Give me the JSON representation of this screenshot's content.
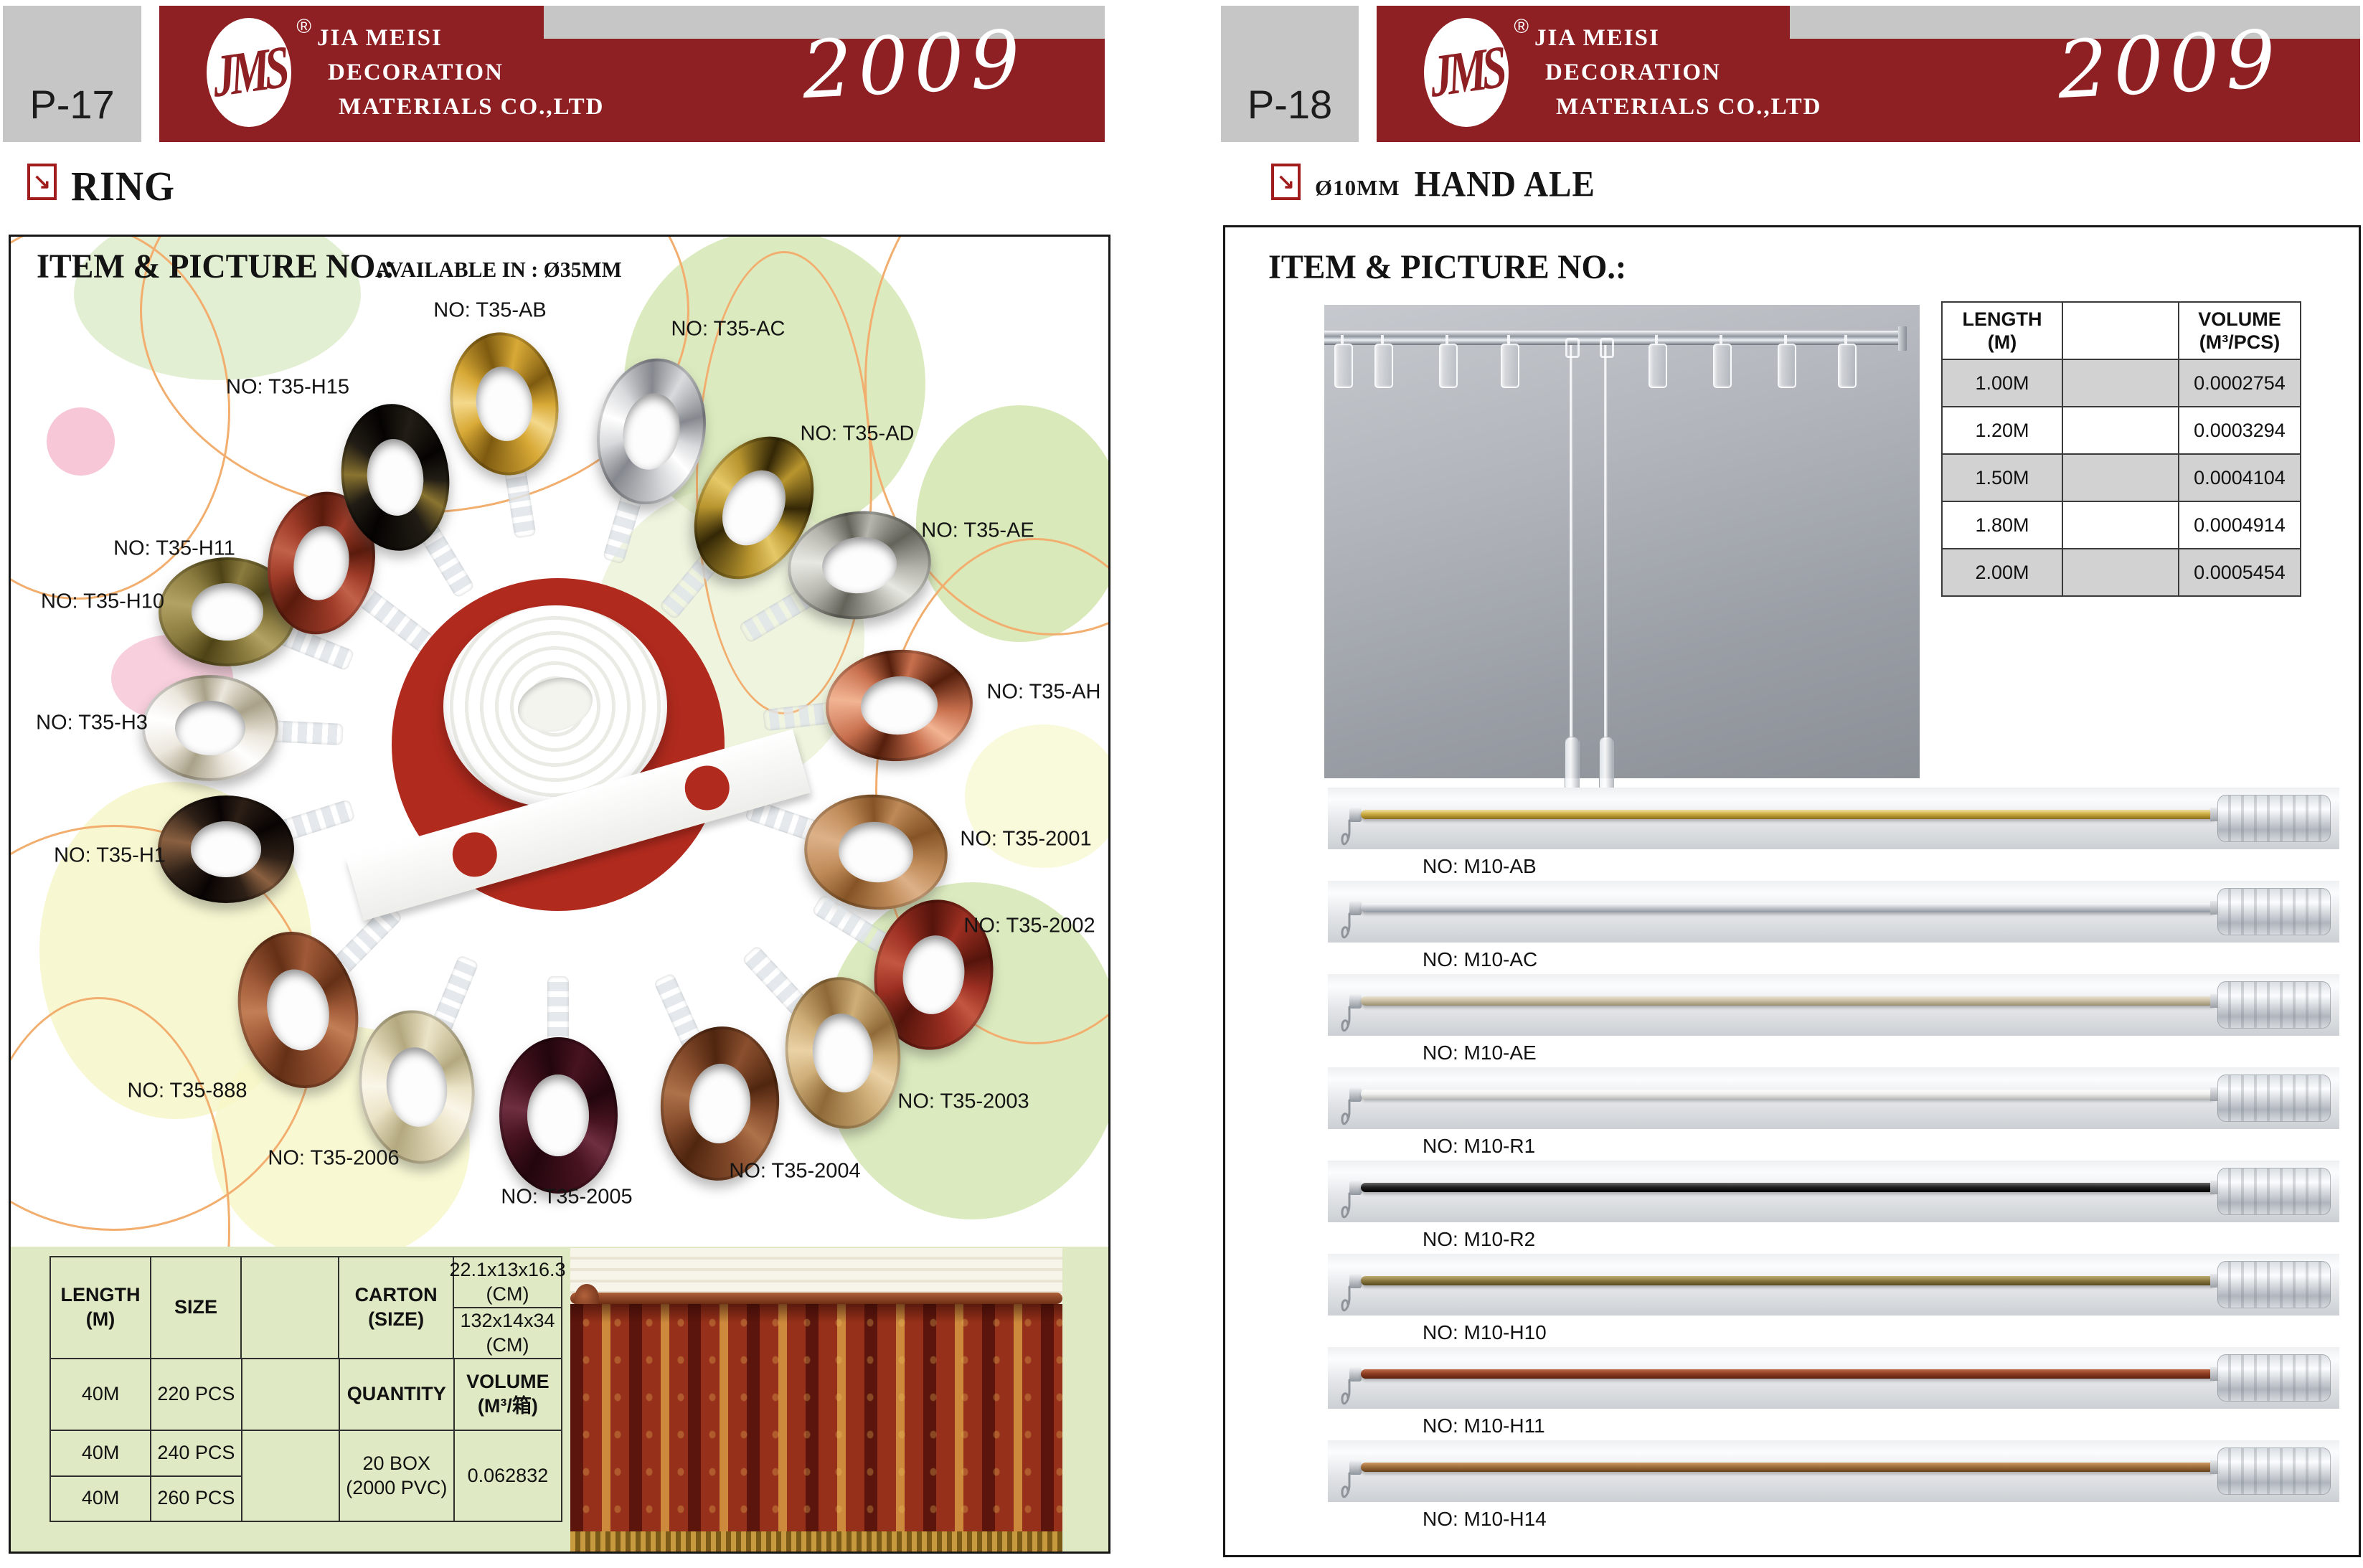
{
  "brand": {
    "logo_text": "JMS",
    "registered_mark": "®",
    "company_lines": [
      "JIA MEISI",
      "DECORATION",
      "MATERIALS CO.,LTD"
    ],
    "year": "2009"
  },
  "icons": {
    "section_arrow": "↘"
  },
  "colors": {
    "band_red": "#8e1f23",
    "accent_red": "#a11c1c",
    "tape_circle_red": "#b02a1e",
    "green_band": "#dfe9c4",
    "table_row_gray": "#d2d2d2",
    "page_label_gray": "#c6c6c6"
  },
  "pages": {
    "left": {
      "page_no": "P-17",
      "section_title": "RING",
      "panel_title": "ITEM & PICTURE NO.:",
      "panel_subtitle": "AVAILABLE IN : Ø35MM",
      "rings": [
        {
          "label": "NO: T35-AB",
          "color": "#d8a936",
          "dark": "#7d5a10",
          "light": "#f4d98c"
        },
        {
          "label": "NO: T35-AC",
          "color": "#d9dadc",
          "dark": "#85888e",
          "light": "#ffffff"
        },
        {
          "label": "NO: T35-AD",
          "color": "#b8952e",
          "dark": "#332706",
          "light": "#e6c868"
        },
        {
          "label": "NO: T35-AE",
          "color": "#b5b5ae",
          "dark": "#63635a",
          "light": "#e8e8e2"
        },
        {
          "label": "NO: T35-AH",
          "color": "#c8704e",
          "dark": "#551f0c",
          "light": "#f2b493"
        },
        {
          "label": "NO: T35-2001",
          "color": "#bf8a58",
          "dark": "#855426",
          "light": "#ddb188"
        },
        {
          "label": "NO: T35-2002",
          "color": "#9c2f22",
          "dark": "#55140b",
          "light": "#c25741"
        },
        {
          "label": "NO: T35-2003",
          "color": "#cfae78",
          "dark": "#8f6a38",
          "light": "#ead2a6"
        },
        {
          "label": "NO: T35-2004",
          "color": "#8a4f2e",
          "dark": "#50260f",
          "light": "#ad7249"
        },
        {
          "label": "NO: T35-2005",
          "color": "#471320",
          "dark": "#23060d",
          "light": "#6f2f41"
        },
        {
          "label": "NO: T35-2006",
          "color": "#ece4c8",
          "dark": "#b3a87e",
          "light": "#faf6e8"
        },
        {
          "label": "NO: T35-888",
          "color": "#a05a38",
          "dark": "#643016",
          "light": "#c27e55"
        },
        {
          "label": "NO: T35-H1",
          "color": "#2c1f16",
          "dark": "#090403",
          "light": "#8a6040"
        },
        {
          "label": "NO: T35-H3",
          "color": "#ece7dd",
          "dark": "#a9a188",
          "light": "#ffffff"
        },
        {
          "label": "NO: T35-H10",
          "color": "#8a7b3e",
          "dark": "#4e4316",
          "light": "#b2a263"
        },
        {
          "label": "NO: T35-H11",
          "color": "#9e3b28",
          "dark": "#5a1b0d",
          "light": "#c2614a"
        },
        {
          "label": "NO: T35-H15",
          "color": "#221d15",
          "dark": "#050302",
          "light": "#8a7430"
        }
      ],
      "table": {
        "length_label": "LENGTH\n(M)",
        "size_label": "SIZE",
        "carton_label": "CARTON\n(SIZE)",
        "carton_size_top": "22.1x13x16.3\n(CM)",
        "carton_size_bottom": "132x14x34\n(CM)",
        "quantity_label": "QUANTITY",
        "volume_label": "VOLUME\n(M³/箱)",
        "rows": [
          [
            "40M",
            "220 PCS"
          ],
          [
            "40M",
            "240 PCS"
          ],
          [
            "40M",
            "260 PCS"
          ]
        ],
        "quantity_value": "20 BOX\n(2000 PVC)",
        "volume_value": "0.062832"
      }
    },
    "right": {
      "page_no": "P-18",
      "section_diameter": "Ø10MM",
      "section_title": "HAND ALE",
      "panel_title": "ITEM & PICTURE NO.:",
      "spec_table": {
        "length_label": "LENGTH\n(M)",
        "volume_label": "VOLUME\n(M³/PCS)",
        "rows": [
          [
            "1.00M",
            "0.0002754"
          ],
          [
            "1.20M",
            "0.0003294"
          ],
          [
            "1.50M",
            "0.0004104"
          ],
          [
            "1.80M",
            "0.0004914"
          ],
          [
            "2.00M",
            "0.0005454"
          ]
        ]
      },
      "rods": [
        {
          "label": "NO: M10-AB",
          "light": "#f0e0a0",
          "mid": "#c9a93f",
          "dark": "#8a6d1a"
        },
        {
          "label": "NO: M10-AC",
          "light": "#fafbfc",
          "mid": "#c8ccd2",
          "dark": "#8e949c"
        },
        {
          "label": "NO: M10-AE",
          "light": "#ece4d0",
          "mid": "#cabfa4",
          "dark": "#978c70"
        },
        {
          "label": "NO: M10-R1",
          "light": "#ffffff",
          "mid": "#efefed",
          "dark": "#bdbdb9"
        },
        {
          "label": "NO: M10-R2",
          "light": "#6a6a6a",
          "mid": "#1e1e1e",
          "dark": "#000000"
        },
        {
          "label": "NO: M10-H10",
          "light": "#c0ad72",
          "mid": "#8b7a42",
          "dark": "#57491c"
        },
        {
          "label": "NO: M10-H11",
          "light": "#c06a4a",
          "mid": "#8c3d22",
          "dark": "#571f0c"
        },
        {
          "label": "NO: M10-H14",
          "light": "#d09a62",
          "mid": "#9c6b3a",
          "dark": "#64401c"
        }
      ]
    }
  }
}
